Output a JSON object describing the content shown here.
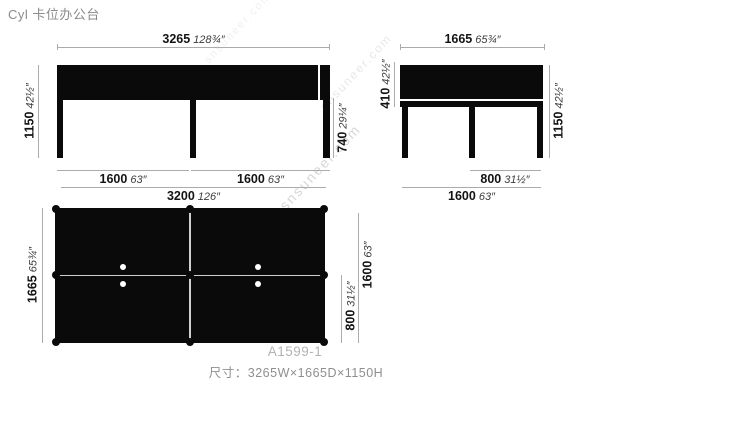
{
  "title": "Cyl 卡位办公台",
  "watermark": {
    "text": "snsuneer.com"
  },
  "colors": {
    "drawing": "#0a0a0a",
    "dim_line": "#ababab",
    "title_text": "#8b8b8b",
    "model_text": "#b3b3b3",
    "size_text": "#8f8f8f"
  },
  "views": {
    "front": {
      "top": {
        "mm": "3265",
        "inch": "128¾″"
      },
      "left": {
        "mm": "1150",
        "inch": "42½″"
      },
      "right": {
        "mm": "740",
        "inch": "29¼″"
      },
      "bottom_left": {
        "mm": "1600",
        "inch": "63″"
      },
      "bottom_right": {
        "mm": "1600",
        "inch": "63″"
      },
      "bottom_total": {
        "mm": "3200",
        "inch": "126″"
      }
    },
    "side": {
      "top": {
        "mm": "1665",
        "inch": "65¾″"
      },
      "left": {
        "mm": "410",
        "inch": "42½″"
      },
      "right": {
        "mm": "1150",
        "inch": "42½″"
      },
      "bottom_half": {
        "mm": "800",
        "inch": "31½″"
      },
      "bottom_total": {
        "mm": "1600",
        "inch": "63″"
      }
    },
    "plan": {
      "left": {
        "mm": "1665",
        "inch": "65¾″"
      },
      "right_half": {
        "mm": "800",
        "inch": "31½″"
      },
      "right_total": {
        "mm": "1600",
        "inch": "63″"
      }
    }
  },
  "footer": {
    "model": "A1599-1",
    "size": "尺寸：3265W×1665D×1150H"
  }
}
